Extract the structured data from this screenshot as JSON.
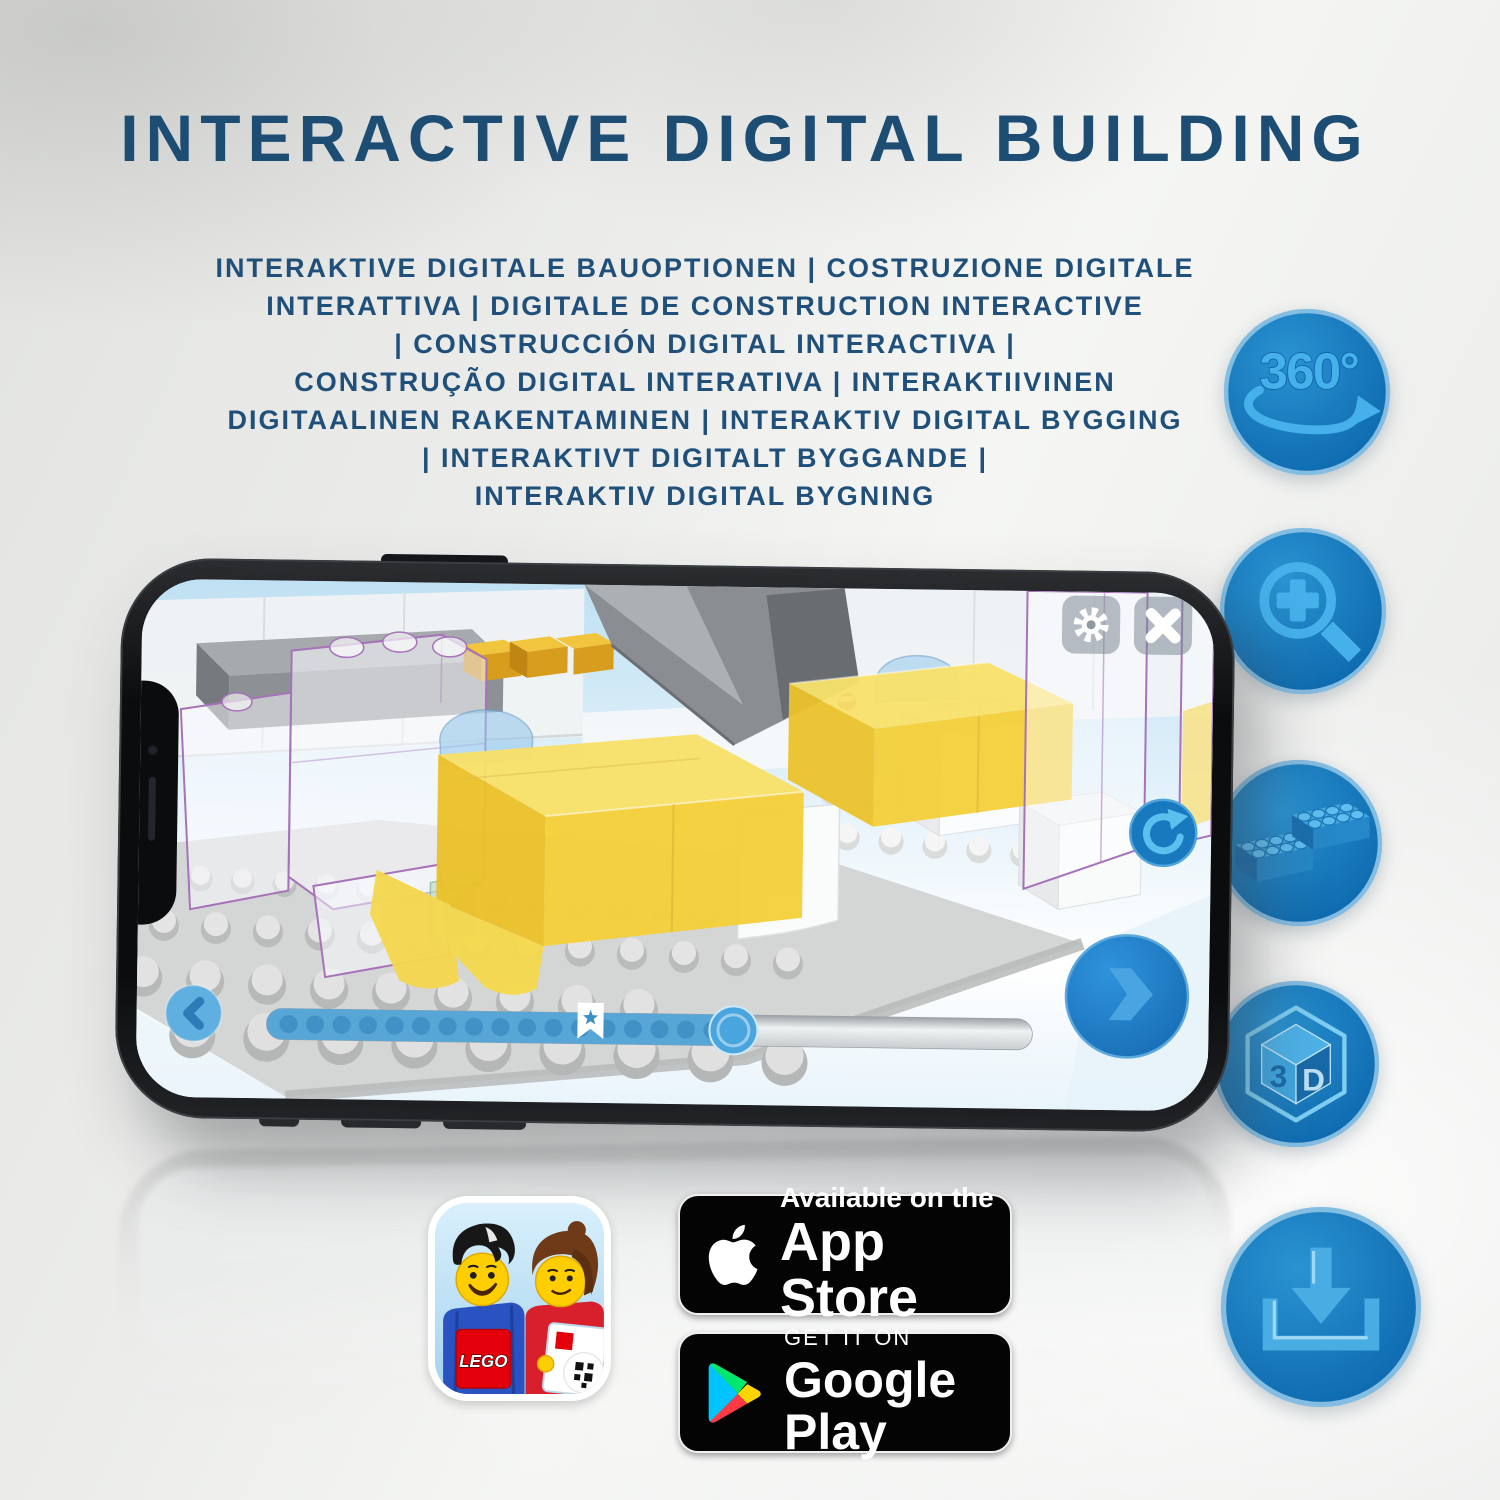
{
  "header": {
    "title": "INTERACTIVE DIGITAL BUILDING",
    "subtitle_lines": [
      "INTERAKTIVE DIGITALE BAUOPTIONEN | COSTRUZIONE DIGITALE",
      "INTERATTIVA | DIGITALE DE CONSTRUCTION INTERACTIVE",
      "| CONSTRUCCIÓN DIGITAL INTERACTIVA |",
      "CONSTRUÇÃO DIGITAL INTERATIVA | INTERAKTIIVINEN",
      "DIGITAALINEN RAKENTAMINEN | INTERAKTIV DIGITAL BYGGING",
      "| INTERAKTIVT DIGITALT BYGGANDE |",
      "INTERAKTIV DIGITAL BYGNING"
    ]
  },
  "feature_rail": {
    "items": [
      {
        "id": "rotate-360",
        "label": "360°"
      },
      {
        "id": "zoom-in",
        "label": ""
      },
      {
        "id": "brick-steps",
        "label": ""
      },
      {
        "id": "view-3d",
        "face_left": "3",
        "face_right": "D"
      },
      {
        "id": "download",
        "label": ""
      }
    ]
  },
  "phone_app": {
    "toolbar": {
      "settings_icon": "gear",
      "close_icon": "x"
    },
    "viewport_buttons": {
      "refresh_icon": "rotate-reset",
      "back_icon": "chevron-left",
      "next_icon": "chevron-right"
    },
    "progress_bar": {
      "percent_filled": 64,
      "visible_step_dots": 17,
      "bookmark_star": true
    }
  },
  "store_links": {
    "lego_app_icon": {
      "logo_text": "LEGO"
    },
    "app_store_badge": {
      "line1": "Available on the",
      "line2": "App Store"
    },
    "google_play_badge": {
      "line1": "GET IT ON",
      "line2": "Google Play"
    }
  },
  "colors": {
    "headline": "#1e4d74",
    "icon_circle": "#0f6cb0",
    "icon_glyph": "#45b0ea",
    "brick_yellow": "#f4d03a",
    "ghost_outline": "#a673b8"
  }
}
